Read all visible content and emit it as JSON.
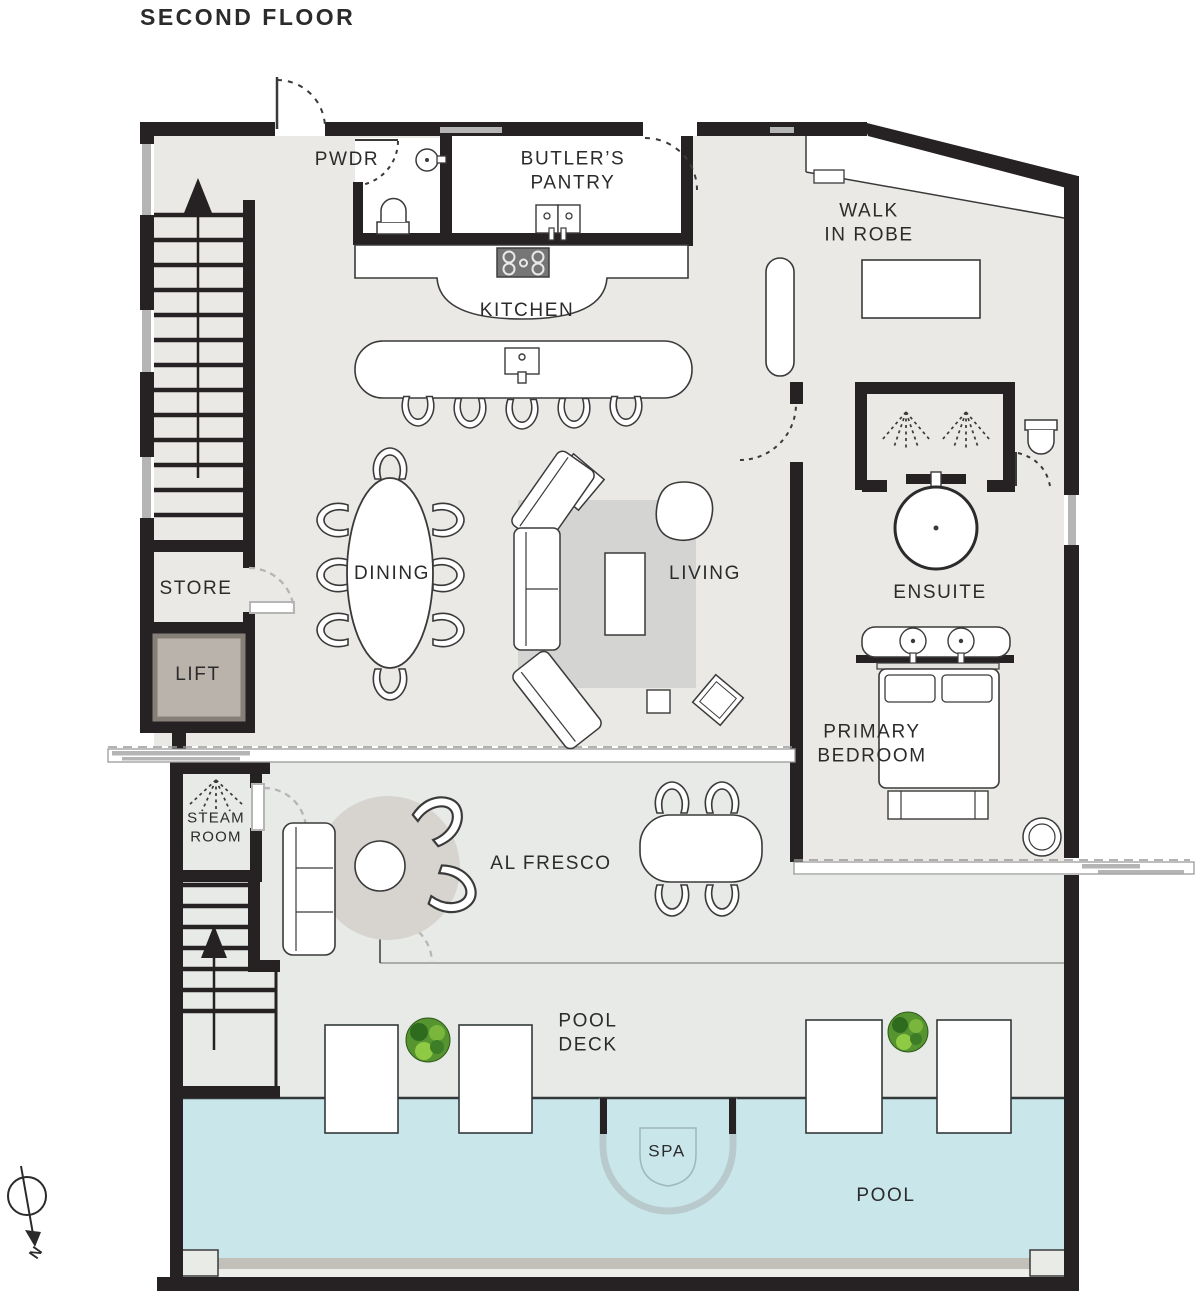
{
  "title": "SECOND FLOOR",
  "compass": {
    "north_label": "N"
  },
  "colors": {
    "wall": "#262223",
    "floor_indoor": "#ebe9e5",
    "floor_outdoor": "#e7eae6",
    "pool_water": "#c9e7eb",
    "rug_gray": "#d4d4d2",
    "door_gray": "#b5b5b5",
    "lift_fill": "#b9b3ac",
    "plant_green": "#55942f",
    "label_text": "#2b2b2b"
  },
  "rooms": {
    "pwdr": {
      "label": "PWDR"
    },
    "butlers_pantry": {
      "lines": [
        "BUTLER’S",
        "PANTRY"
      ]
    },
    "walk_in_robe": {
      "lines": [
        "WALK",
        "IN ROBE"
      ]
    },
    "kitchen": {
      "label": "KITCHEN"
    },
    "dining": {
      "label": "DINING"
    },
    "living": {
      "label": "LIVING"
    },
    "ensuite": {
      "label": "ENSUITE"
    },
    "store": {
      "label": "STORE"
    },
    "lift": {
      "label": "LIFT"
    },
    "primary_bedroom": {
      "lines": [
        "PRIMARY",
        "BEDROOM"
      ]
    },
    "steam_room": {
      "lines": [
        "STEAM",
        "ROOM"
      ]
    },
    "al_fresco": {
      "label": "AL FRESCO"
    },
    "pool_deck": {
      "lines": [
        "POOL",
        "DECK"
      ]
    },
    "spa": {
      "label": "SPA"
    },
    "pool": {
      "label": "POOL"
    }
  }
}
